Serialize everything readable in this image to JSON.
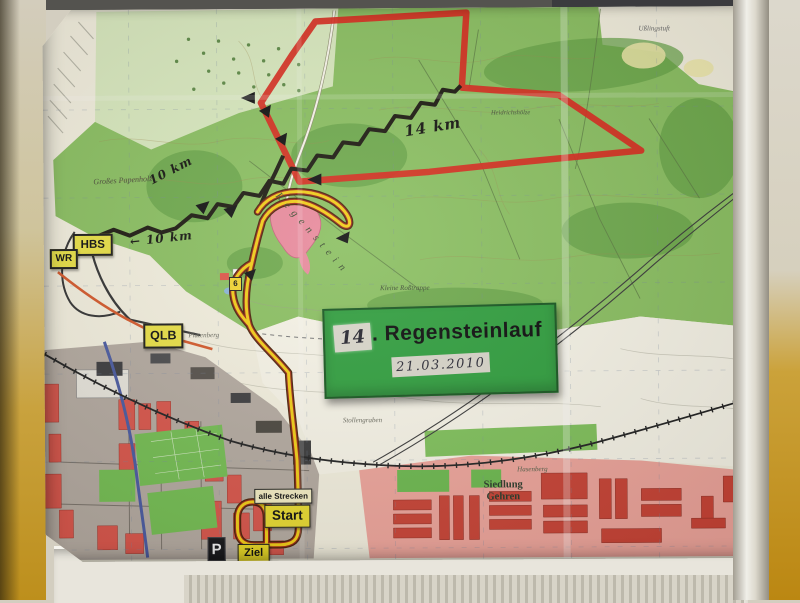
{
  "sign": {
    "edition": "14",
    "title_suffix": ". Regensteinlauf",
    "date": "21.03.2010"
  },
  "markers": {
    "hbs": "HBS",
    "wr": "WR",
    "qlb": "QLB",
    "parking": "P",
    "start": "Start",
    "finish": "Ziel",
    "all_courses": "alle Strecken",
    "road_number": "6"
  },
  "route_annotations": {
    "red_distance": "14 km",
    "black_distance_upper": "10 km",
    "black_distance_lower": "10 km",
    "arrow_left": "←"
  },
  "place_names": {
    "forest_nw": "Großes Papenholz",
    "ridge": "Regenstein",
    "cliff": "Kleine Roßtrappe",
    "hill_w": "Platenberg",
    "ditch": "Stollengraben",
    "settlement": "Siedlung Gehren",
    "hill_se": "Hasenberg",
    "forest_e": "Heidrichshölze",
    "field_ne": "Ußlingstuft"
  },
  "colors": {
    "route_red": "#d8281c",
    "route_black": "#1c1910",
    "route_combined_yellow": "#f1cd15",
    "route_combined_casing": "#4a2208",
    "sign_green": "#2f9e3d",
    "marker_yellow": "#e9e045",
    "forest_green": "#8abf60",
    "urban_red": "#d8554a",
    "wall_yellow": "#c79a33"
  }
}
